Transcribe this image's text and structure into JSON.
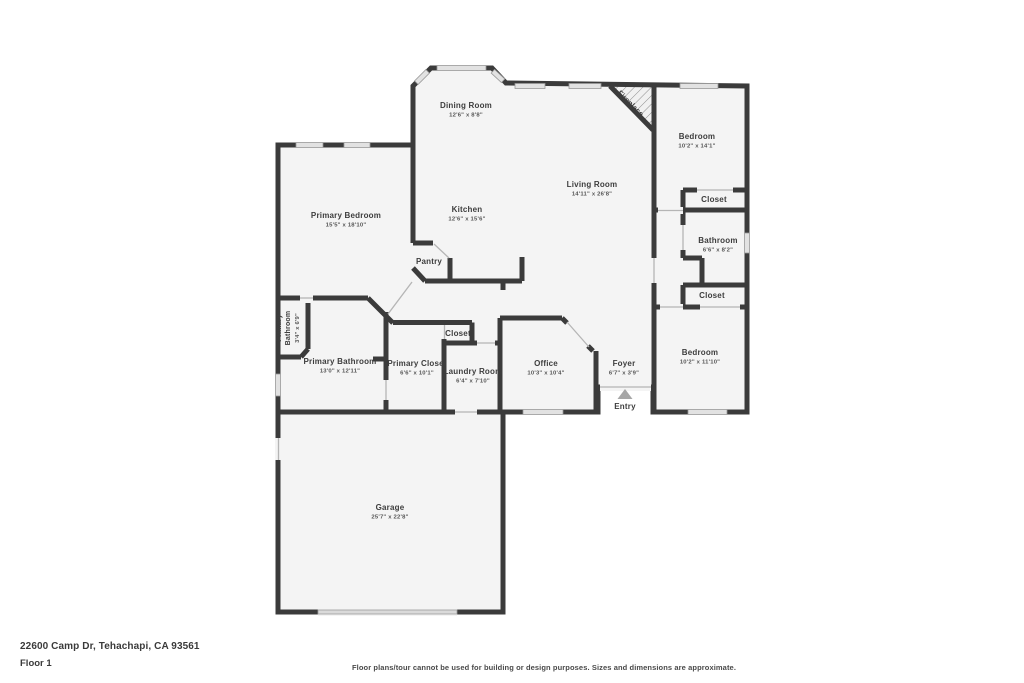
{
  "page": {
    "address": "22600 Camp Dr, Tehachapi, CA 93561",
    "floor_label": "Floor 1",
    "disclaimer": "Floor plans/tour cannot be used for building or design purposes. Sizes and dimensions are approximate."
  },
  "floorplan": {
    "entry_marker": "Entry",
    "rooms": [
      {
        "id": "dining-room",
        "name": "Dining Room",
        "dims": "12'6\" x 8'8\""
      },
      {
        "id": "living-room",
        "name": "Living Room",
        "dims": "14'11\" x 26'8\""
      },
      {
        "id": "kitchen",
        "name": "Kitchen",
        "dims": "12'6\" x 15'6\""
      },
      {
        "id": "pantry",
        "name": "Pantry",
        "dims": ""
      },
      {
        "id": "fireplace",
        "name": "Fireplace",
        "dims": ""
      },
      {
        "id": "primary-bedroom",
        "name": "Primary Bedroom",
        "dims": "15'5\" x 18'10\""
      },
      {
        "id": "bedroom-1",
        "name": "Bedroom",
        "dims": "10'2\" x 14'1\""
      },
      {
        "id": "closet-1",
        "name": "Closet",
        "dims": ""
      },
      {
        "id": "bathroom",
        "name": "Bathroom",
        "dims": "6'6\" x 8'2\""
      },
      {
        "id": "closet-2",
        "name": "Closet",
        "dims": ""
      },
      {
        "id": "bedroom-2",
        "name": "Bedroom",
        "dims": "10'2\" x 11'10\""
      },
      {
        "id": "foyer",
        "name": "Foyer",
        "dims": "6'7\" x 3'9\""
      },
      {
        "id": "entry",
        "name": "Entry",
        "dims": ""
      },
      {
        "id": "office",
        "name": "Office",
        "dims": "10'3\" x 10'4\""
      },
      {
        "id": "laundry-room",
        "name": "Laundry Room",
        "dims": "6'4\" x 7'10\""
      },
      {
        "id": "closet-3",
        "name": "Closet",
        "dims": ""
      },
      {
        "id": "primary-closet",
        "name": "Primary Closet",
        "dims": "6'6\" x 10'1\""
      },
      {
        "id": "primary-bathroom",
        "name": "Primary Bathroom",
        "dims": "13'0\" x 12'11\""
      },
      {
        "id": "primary-bathroom-small",
        "name": "Primary Bathroom",
        "dims": "3'4\" x 6'9\""
      },
      {
        "id": "garage",
        "name": "Garage",
        "dims": "25'7\" x 22'8\""
      }
    ],
    "colors": {
      "wall": "#3b3b3b",
      "floor": "#f4f4f4",
      "window": "#e2e2e2",
      "door_line": "#b5b5b5",
      "entry_arrow": "#a6a6a6",
      "label": "#3d3d3d",
      "dims": "#555555"
    }
  }
}
